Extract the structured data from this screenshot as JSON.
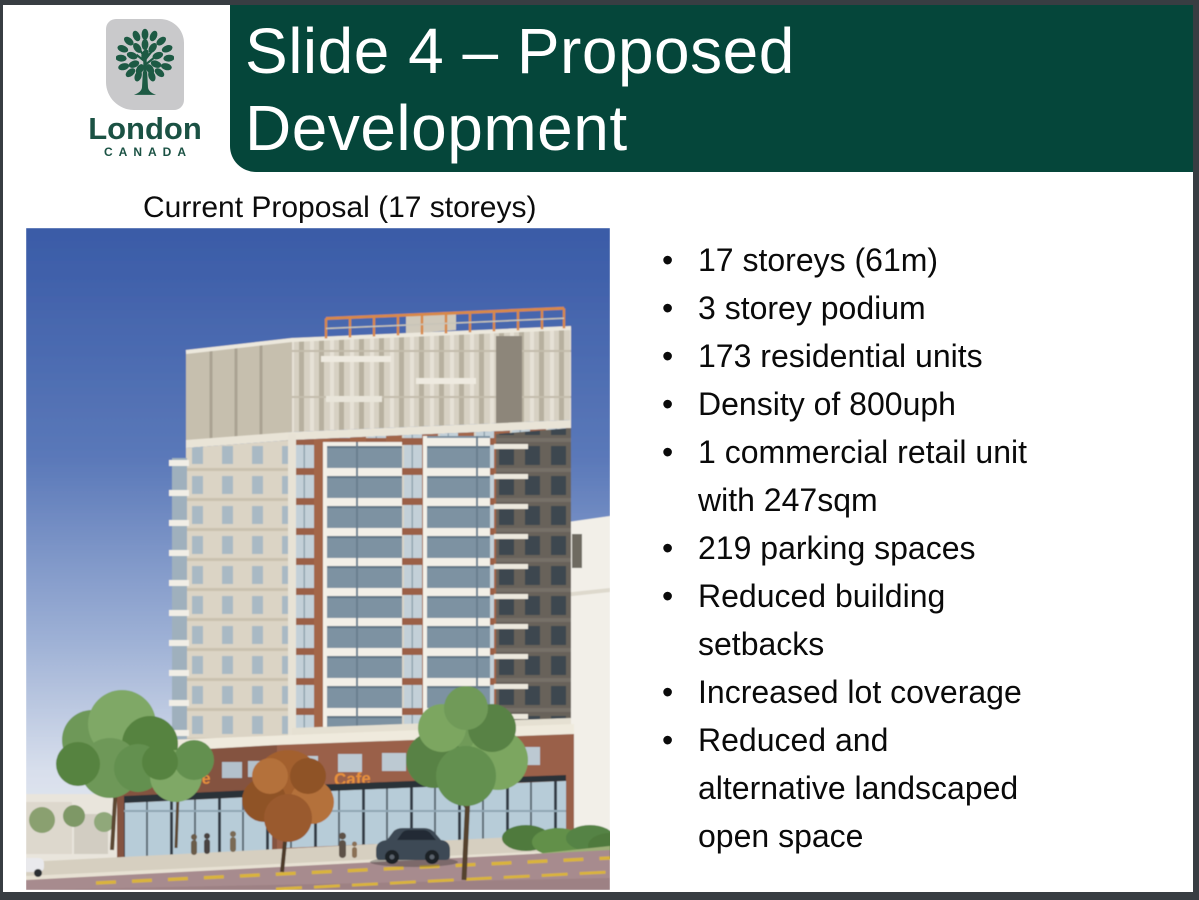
{
  "logo": {
    "name": "London",
    "subtitle": "CANADA"
  },
  "header": {
    "title_line1": "Slide 4 – Proposed",
    "title_line2": "Development"
  },
  "caption": "Current Proposal (17 storeys)",
  "bullets": [
    "17 storeys (61m)",
    "3 storey podium",
    "173 residential units",
    "Density of 800uph",
    "1 commercial retail unit\nwith 247sqm",
    "219 parking spaces",
    "Reduced building\nsetbacks",
    "Increased lot coverage",
    "Reduced and\nalternative landscaped\nopen space"
  ],
  "photo": {
    "sign_text": "Cafe"
  },
  "colors": {
    "header_green": "#05463a",
    "logo_green": "#1d5a44",
    "sky_blue": "#3a5ba7",
    "brick": "#a3664a",
    "sign_orange": "#e8913c"
  }
}
